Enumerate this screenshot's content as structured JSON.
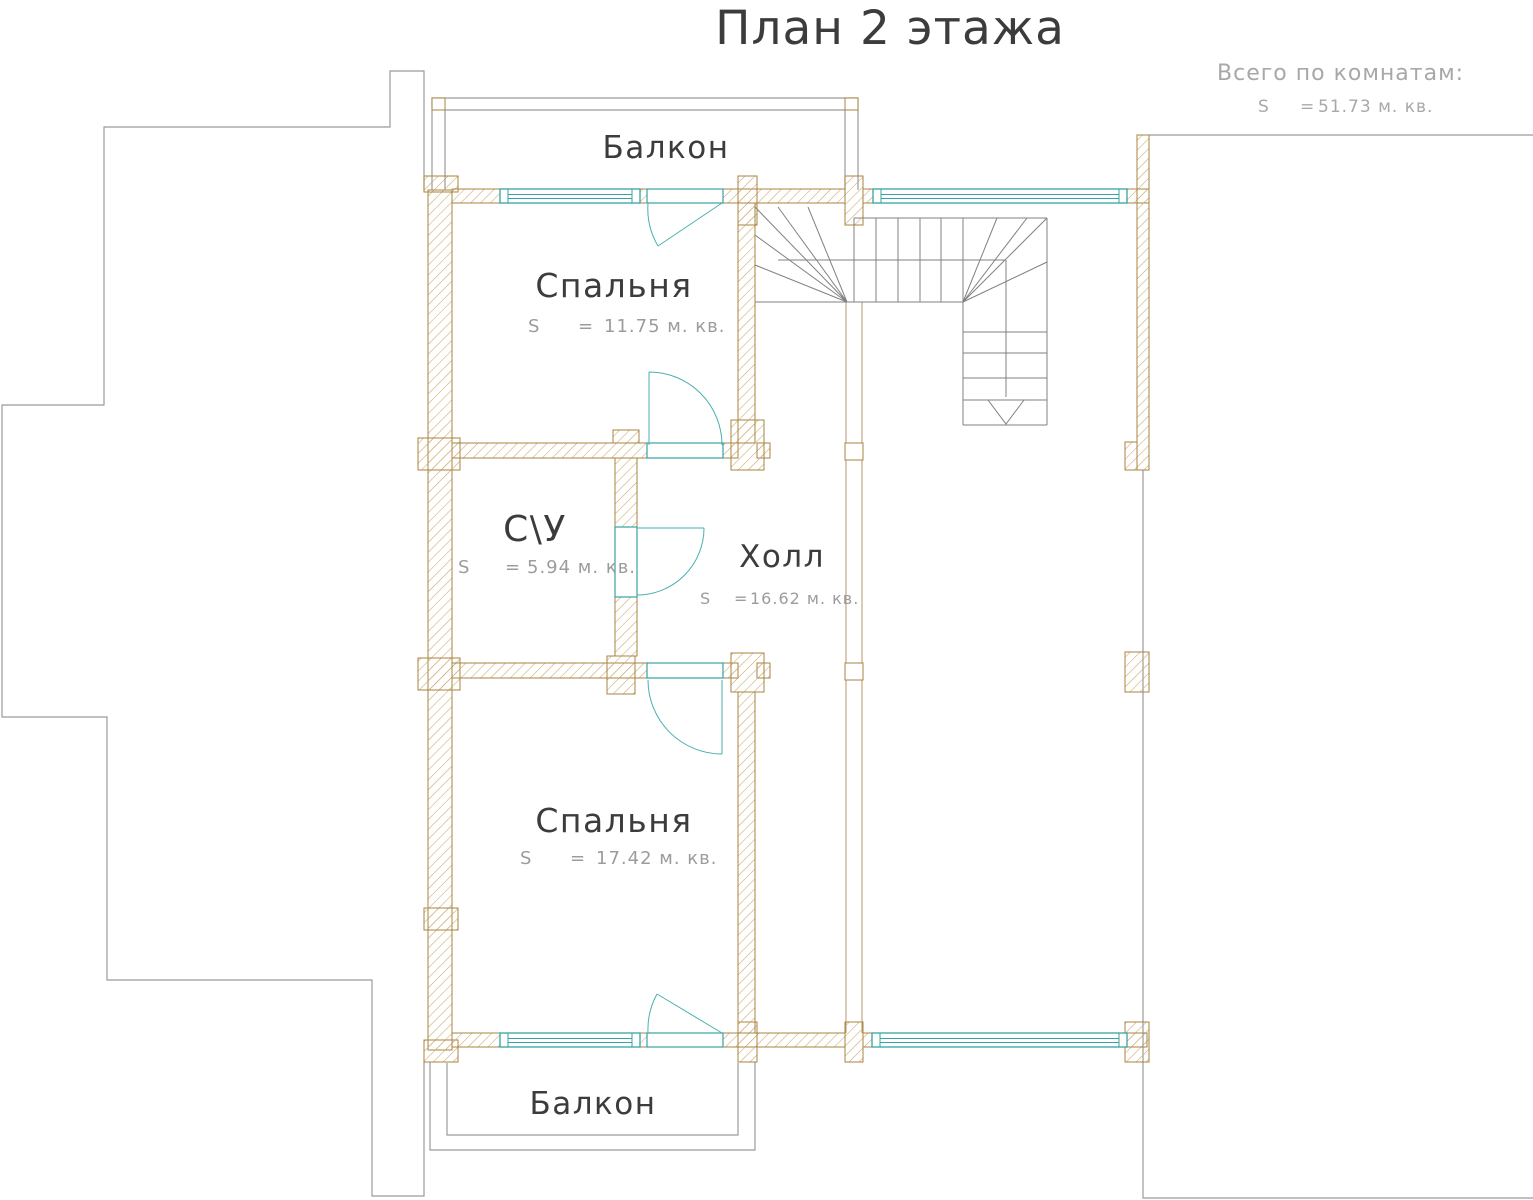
{
  "title": "План 2 этажа",
  "summary": {
    "label": "Всего по комнатам:",
    "s": "S",
    "eq": "=",
    "value": "51.73 м. кв."
  },
  "rooms": {
    "balcony_top": {
      "name": "Балкон"
    },
    "bedroom1": {
      "name": "Спальня",
      "s": "S",
      "eq": "=",
      "area": "11.75 м. кв."
    },
    "wc": {
      "name": "С\\У",
      "s": "S",
      "eq": "=",
      "area": "5.94 м. кв."
    },
    "hall": {
      "name": "Холл",
      "s": "S",
      "eq": "=",
      "area": "16.62 м. кв."
    },
    "bedroom2": {
      "name": "Спальня",
      "s": "S",
      "eq": "=",
      "area": "17.42 м. кв."
    },
    "balcony_bottom": {
      "name": "Балкон"
    }
  },
  "colors": {
    "wall_outline": "#a8833f",
    "wall_hatch": "#c9a768",
    "window_door": "#35a3a3",
    "floor_outline_gray": "#9b9b9b",
    "stairs_gray": "#818181",
    "text_dark": "#3c3c3c",
    "text_gray": "#9c9c9c"
  }
}
